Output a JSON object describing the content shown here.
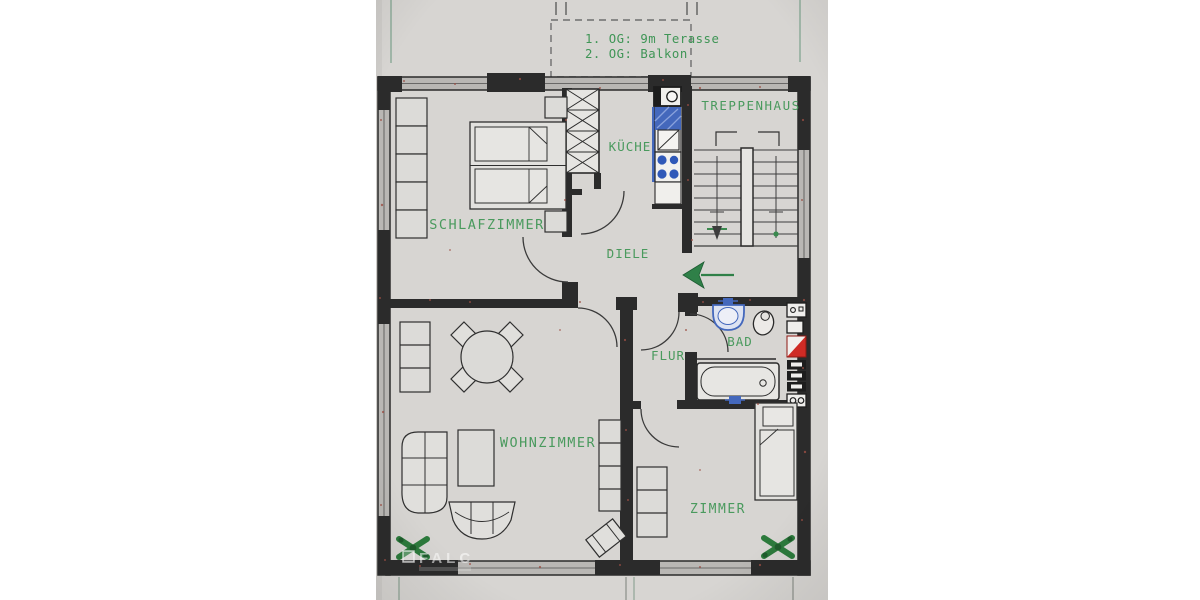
{
  "plan": {
    "annotation": {
      "line1": "1. OG: 9m Terasse",
      "line2": "2. OG: Balkon"
    },
    "rooms": {
      "treppenhaus": "TREPPENHAUS",
      "kueche": "KÜCHE",
      "schlafzimmer": "SCHLAFZIMMER",
      "diele": "DIELE",
      "flur": "FLUR",
      "bad": "BAD",
      "wohnzimmer": "WOHNZIMMER",
      "zimmer": "ZIMMER"
    },
    "watermark": "FALC",
    "icons": [
      "chimney-shaft-x-icon",
      "stairs-icon",
      "stair-direction-arrow-icon",
      "entrance-arrow-icon",
      "boiler-icon",
      "kitchen-sink-icon",
      "stove-icon",
      "washbasin-icon",
      "toilet-icon",
      "bathtub-icon",
      "riser-shaft-red-icon",
      "appliance-stack-icon",
      "meter-box-icon",
      "socket-box-icon",
      "double-bed-icon",
      "single-bed-icon",
      "wardrobe-icon",
      "nightstand-icon",
      "dining-table-icon",
      "chair-icon",
      "couch-icon",
      "armchair-icon",
      "coffee-table-icon",
      "shelf-icon",
      "tv-icon",
      "plant-icon"
    ],
    "colors": {
      "paper": "#d7d5d2",
      "wall": "#2b2b2b",
      "label_green": "#4a9a5e",
      "note_green": "#3f9556",
      "fixture_blue": "#4468bc",
      "burner_blue": "#2f58b8",
      "shaft_red": "#cf2b25",
      "arrow_green": "#2f8048",
      "plant_green": "#2c7a3c"
    }
  }
}
